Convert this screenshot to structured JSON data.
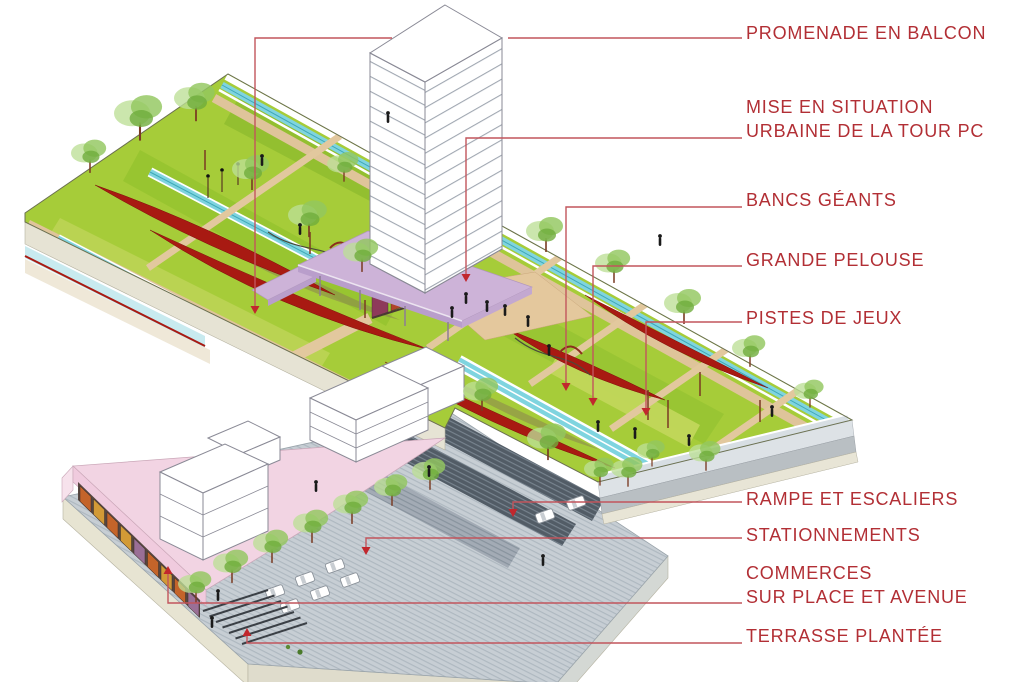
{
  "palette": {
    "label_text": "#b22f35",
    "leader_line": "#c2555c",
    "arrow_head": "#c1272d",
    "lawn_green": "#a6cc39",
    "bench_red": "#a81a12",
    "water_cyan": "#7fd4df",
    "path_tan": "#dfc49a",
    "canopy_pink": "#cdb3d8",
    "building_pink": "#f2d4e3",
    "parking_gray": "#c7ced4"
  },
  "annotations": [
    {
      "id": "promenade-en-balcon",
      "line1": "PROMENADE EN BALCON",
      "line2": "",
      "label_x": 746,
      "label_y": 21,
      "leader": [
        [
          742,
          38
        ],
        [
          508,
          38
        ]
      ],
      "leader_b": [
        [
          392,
          38
        ],
        [
          255,
          38
        ],
        [
          255,
          306
        ]
      ],
      "arrow_dir": "down"
    },
    {
      "id": "mise-en-situation-urbaine",
      "line1": "MISE EN SITUATION",
      "line2": "URBAINE DE LA TOUR PC",
      "label_x": 746,
      "label_y": 95,
      "leader": [
        [
          742,
          138
        ],
        [
          466,
          138
        ],
        [
          466,
          274
        ]
      ],
      "arrow_dir": "down"
    },
    {
      "id": "bancs-geants",
      "line1": "BANCS GÉANTS",
      "line2": "",
      "label_x": 746,
      "label_y": 188,
      "leader": [
        [
          742,
          207
        ],
        [
          566,
          207
        ],
        [
          566,
          383
        ]
      ],
      "arrow_dir": "down"
    },
    {
      "id": "grande-pelouse",
      "line1": "GRANDE PELOUSE",
      "line2": "",
      "label_x": 746,
      "label_y": 248,
      "leader": [
        [
          742,
          266
        ],
        [
          593,
          266
        ],
        [
          593,
          398
        ]
      ],
      "arrow_dir": "down"
    },
    {
      "id": "pistes-de-jeux",
      "line1": "PISTES DE JEUX",
      "line2": "",
      "label_x": 746,
      "label_y": 306,
      "leader": [
        [
          742,
          322
        ],
        [
          646,
          322
        ],
        [
          646,
          408
        ]
      ],
      "arrow_dir": "down"
    },
    {
      "id": "rampe-et-escaliers",
      "line1": "RAMPE ET ESCALIERS",
      "line2": "",
      "label_x": 746,
      "label_y": 487,
      "leader": [
        [
          742,
          502
        ],
        [
          513,
          502
        ],
        [
          513,
          509
        ]
      ],
      "arrow_dir": "down"
    },
    {
      "id": "stationnements",
      "line1": "STATIONNEMENTS",
      "line2": "",
      "label_x": 746,
      "label_y": 523,
      "leader": [
        [
          742,
          538
        ],
        [
          366,
          538
        ],
        [
          366,
          547
        ]
      ],
      "arrow_dir": "down"
    },
    {
      "id": "commerces",
      "line1": "COMMERCES",
      "line2": "SUR PLACE ET AVENUE",
      "label_x": 746,
      "label_y": 561,
      "leader": [
        [
          742,
          603
        ],
        [
          168,
          603
        ],
        [
          168,
          574
        ]
      ],
      "arrow_dir": "up"
    },
    {
      "id": "terrasse-plantee",
      "line1": "TERRASSE PLANTÉE",
      "line2": "",
      "label_x": 746,
      "label_y": 624,
      "leader": [
        [
          742,
          643
        ],
        [
          247,
          643
        ],
        [
          247,
          636
        ]
      ],
      "arrow_dir": "up"
    }
  ]
}
